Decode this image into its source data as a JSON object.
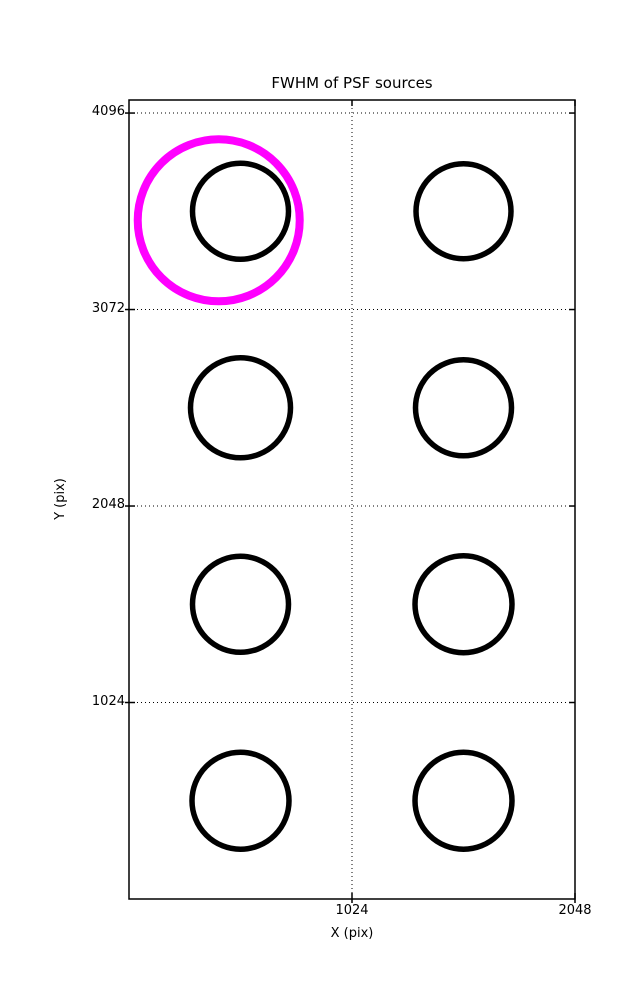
{
  "chart_data": {
    "type": "scatter",
    "title": "FWHM of PSF sources",
    "xlabel": "X (pix)",
    "ylabel": "Y (pix)",
    "xlim": [
      0,
      2048
    ],
    "ylim": [
      0,
      4164
    ],
    "xticks": [
      1024,
      2048
    ],
    "yticks": [
      1024,
      2048,
      3072,
      4096
    ],
    "grid": {
      "style": "dotted",
      "color": "#000000",
      "x_gridlines": [
        1024
      ],
      "y_gridlines": [
        1024,
        2048,
        3072,
        4096
      ]
    },
    "axes_color": "#000000",
    "background_color": "#ffffff",
    "legend": "none",
    "series": [
      {
        "name": "psf-source",
        "marker": "open-circle",
        "color": "#000000",
        "stroke_px": 5.5,
        "points": [
          {
            "x": 512,
            "y": 3584,
            "r_px": 48.0
          },
          {
            "x": 1536,
            "y": 3584,
            "r_px": 47.5
          },
          {
            "x": 512,
            "y": 2560,
            "r_px": 50.0
          },
          {
            "x": 1536,
            "y": 2560,
            "r_px": 48.0
          },
          {
            "x": 512,
            "y": 1536,
            "r_px": 48.0
          },
          {
            "x": 1536,
            "y": 1536,
            "r_px": 48.5
          },
          {
            "x": 512,
            "y": 512,
            "r_px": 48.5
          },
          {
            "x": 1536,
            "y": 512,
            "r_px": 48.5
          }
        ]
      },
      {
        "name": "highlighted-source",
        "marker": "open-circle",
        "color": "#ff00ff",
        "stroke_px": 8,
        "points": [
          {
            "x": 412,
            "y": 3537,
            "r_px": 81
          }
        ]
      }
    ]
  }
}
